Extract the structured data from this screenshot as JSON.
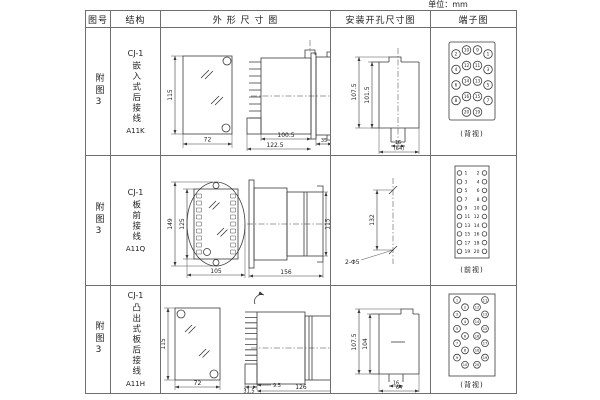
{
  "unit_label": "单位：mm",
  "header": {
    "fig_no": "图号",
    "structure": "结构",
    "outline": "外 形 尺 寸 图",
    "install": "安装开孔尺寸图",
    "terminal": "端子图"
  },
  "rows": [
    {
      "fig_no": "附图3",
      "model": "CJ-1",
      "desc": "嵌入式后接线",
      "code": "A11K",
      "dims": {
        "front_h": "115",
        "front_w": "72",
        "body": "100.5",
        "total": "122.5",
        "rear": "35",
        "cut_outer": "107.5",
        "cut_inner": "101.5",
        "notch": "16",
        "cut_w": "(64)"
      },
      "terminal_label": "(背视)"
    },
    {
      "fig_no": "附图3",
      "model": "CJ-1",
      "desc": "板前接线",
      "code": "A11Q",
      "dims": {
        "front_h": "149",
        "front_inner": "125",
        "front_w": "105",
        "length": "156",
        "side_h": "115",
        "span": "132",
        "holes": "2-Φ5"
      },
      "terminal_label": "(前视)"
    },
    {
      "fig_no": "附图3",
      "model": "CJ-1",
      "desc": "凸出式板后接线",
      "code": "A11H",
      "dims": {
        "front_h": "115",
        "front_w": "72",
        "comb": "31.5",
        "gap": "9.5",
        "length": "126",
        "cut_outer": "107.5",
        "cut_inner": "104",
        "notch": "16",
        "cut_w": "64"
      },
      "terminal_label": "(背视)"
    }
  ],
  "terminals": {
    "row1": {
      "outer_left": [
        "2",
        "4",
        "6",
        "8"
      ],
      "inner_left": [
        "10",
        "12",
        "14",
        "16",
        "20"
      ],
      "inner_right": [
        "9",
        "11",
        "13",
        "15",
        "19"
      ],
      "outer_right": [
        "1",
        "3",
        "5",
        "7"
      ]
    },
    "row2": {
      "left": [
        "1",
        "3",
        "5",
        "7",
        "9",
        "11",
        "13",
        "15",
        "17",
        "19"
      ],
      "right": [
        "2",
        "4",
        "6",
        "8",
        "10",
        "12",
        "14",
        "16",
        "18",
        "20"
      ]
    },
    "row3": {
      "left": [
        "1",
        "2",
        "3",
        "4",
        "5",
        "6",
        "7",
        "8",
        "9",
        "10"
      ],
      "right": [
        "11",
        "12",
        "13",
        "14",
        "15",
        "16",
        "17",
        "18",
        "19",
        "20"
      ]
    }
  }
}
